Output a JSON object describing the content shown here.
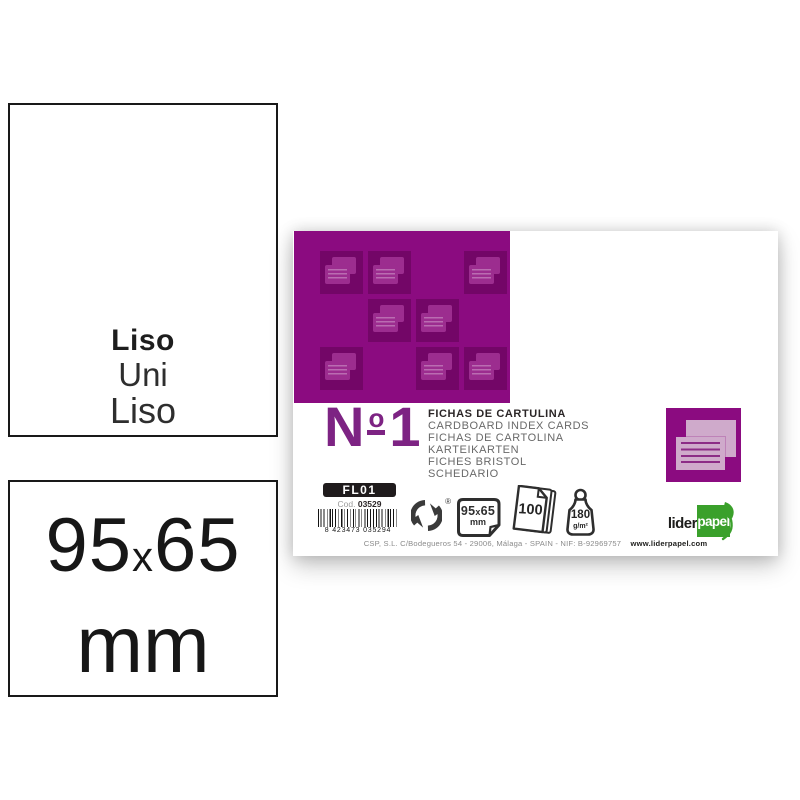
{
  "left_panel": {
    "texture_box": {
      "line1": "Liso",
      "line2": "Uni",
      "line3": "Liso"
    },
    "size_box": {
      "num1": "95",
      "sep": "x",
      "num2": "65",
      "unit": "mm"
    }
  },
  "package": {
    "product_number": {
      "n": "N",
      "ordinal": "o",
      "digit": "1"
    },
    "titles": [
      "FICHAS DE CARTULINA",
      "CARDBOARD INDEX CARDS",
      "FICHAS DE CARTOLINA",
      "KARTEIKARTEN",
      "FICHES BRISTOL",
      "SCHEDARIO"
    ],
    "ref_code": "FL01",
    "cod_label": "Cod.",
    "cod_value": "03529",
    "barcode_digits": "8 423473 035294",
    "recycle_reg_mark": "®",
    "size_icon": {
      "num1": "95",
      "sep": "x",
      "num2": "65",
      "unit": "mm"
    },
    "count_icon": {
      "value": "100"
    },
    "weight_icon": {
      "value": "180",
      "unit": "g/m²"
    },
    "brand": {
      "part1": "lider",
      "part2": "papel"
    },
    "footer": {
      "address": "CSP, S.L. C/Bodegueros 54 - 29006, Málaga - SPAIN - NIF: B-92969757",
      "website": "www.liderpapel.com"
    },
    "pattern_cells": [
      [
        26,
        20
      ],
      [
        74,
        20
      ],
      [
        170,
        20
      ],
      [
        74,
        68
      ],
      [
        122,
        68
      ],
      [
        26,
        116
      ],
      [
        122,
        116
      ],
      [
        170,
        116
      ]
    ],
    "icon_names": [
      "green-dot-recycle-icon",
      "card-size-icon",
      "sheet-count-icon",
      "grammage-weight-icon",
      "index-cards-icon"
    ]
  },
  "colors": {
    "purple": "#8b0b80",
    "purple_dark": "#730667",
    "purple_card": "#9c2d8f",
    "lilac": "#cfaacb",
    "lilac_line": "#8c2c86",
    "green": "#3aa02b",
    "ink": "#2b2627",
    "gray": "#686868"
  }
}
